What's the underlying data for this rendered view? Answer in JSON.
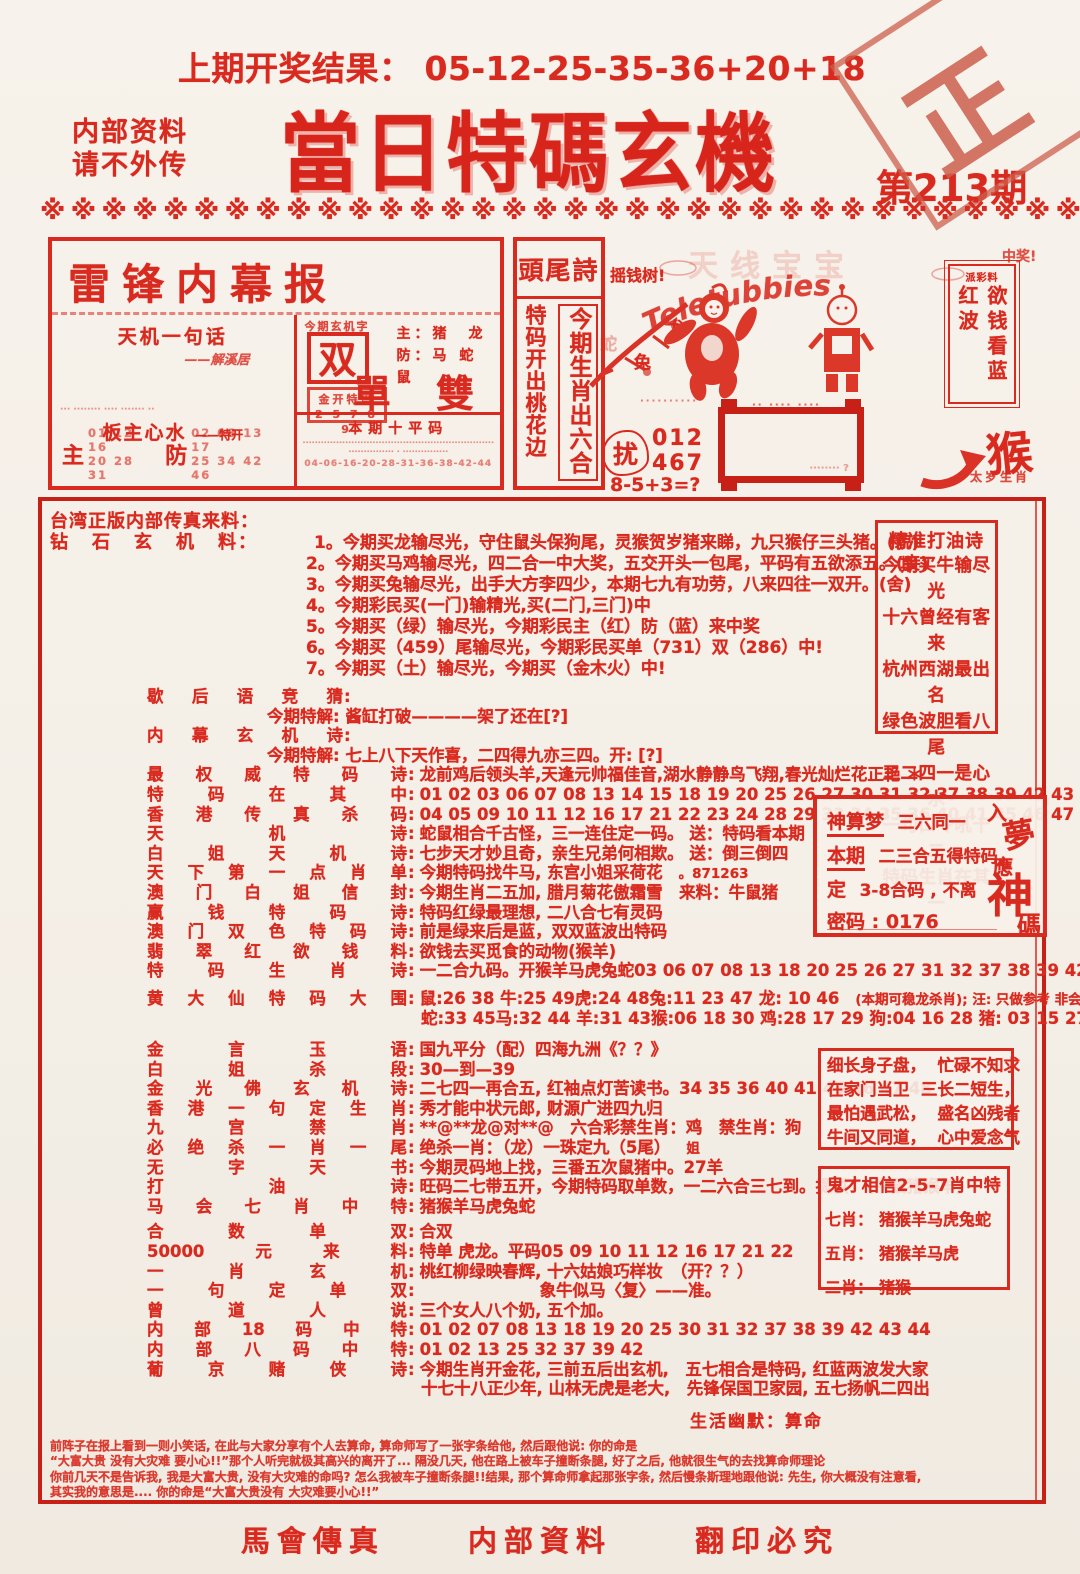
{
  "header": {
    "prev_result": "上期开奖结果： 05-12-25-35-36+20+18",
    "confidential_1": "内部资料",
    "confidential_2": "请不外传",
    "title": "當日特碼玄機",
    "issue": "第213期",
    "stamp_char_1": "正",
    "stamp_char_2": "版",
    "divider": "※※※※※※※※※※※※※※※※※※※※※※※※※※※※※※※※※※※※"
  },
  "leifeng": {
    "title": "雷锋内幕报",
    "tianji_title": "天机一句话",
    "tianji_sig": "——解溪居",
    "smudge": "··· ········ ···· ······· ··",
    "banzhu": "板主心水",
    "banzhu_sub": "——特开",
    "zhu_label": "主",
    "zhu_nums_1": "01 12 16",
    "zhu_nums_2": "20 28 31",
    "fang_label": "防",
    "fang_nums_1": "02 08 13 17",
    "fang_nums_2": "25 34 42 46",
    "xuanji_head": "今期玄机字",
    "xuanji_char": "双",
    "zhu_line": "主：猪　龙",
    "fang_line": "防：马 蛇 鼠",
    "jk_line1": "金开特玛",
    "jk_line2": "2 5 7 8 9",
    "dan_shuang": "單 雙",
    "ten_title": "本期十平码",
    "ten_smudge1": "·······························································",
    "ten_smudge2": "··············· · ···············",
    "ten_nums": "04-06-16-20-28-31-36-38-42-44"
  },
  "touwei": {
    "title": "頭尾詩",
    "left_verse": "特码开出桃花边",
    "right_verse": "今期生肖出六合"
  },
  "tele": {
    "faint_cn": "天线宝宝",
    "arc": "Teletubbies",
    "money_tree": "摇钱树!",
    "win": "中奖!",
    "branch_char_1": "龙",
    "branch_char_2": "兔",
    "branch_char_3": "蛇",
    "rao": "扰",
    "nums_1": "012",
    "nums_2": "467",
    "formula": "8-5+3=?",
    "banner_smudge_1": "··········",
    "banner_smudge_2": "·· ···· ····",
    "box_smudge": "········ ?",
    "monkey": "猴",
    "monkey_caption": "太岁生肖"
  },
  "paicai": {
    "head": "派彩料",
    "body": "欲钱看蓝红波"
  },
  "sec1": {
    "intro": "台湾正版内部传真来料：",
    "label": "钻石玄机料",
    "colon": "：",
    "first": "1。今期买龙输尽光，守住鼠头保狗尾，灵猴贺岁猪来睇，九只猴仔三头猪。(貌)",
    "items": [
      "2。今期买马鸡输尽光，四二合一中大奖，五交开头一包尾，平码有五欲添五。(妾)",
      "3。今期买兔输尽光，出手大方李四少，本期七九有功劳，八来四往一双开。(舍)",
      "4。今期彩民买(一门)输精光,买(二门,三门)中",
      "5。今期买（绿）输尽光，今期彩民主（红）防（蓝）来中奖",
      "6。今期买（459）尾输尽光，今期彩民买单（731）双（286）中!",
      "7。今期买（土）输尽光，今期买（金木火）中!"
    ]
  },
  "main": {
    "rows": [
      {
        "c": "s g8",
        "l": "歇后语竞猜",
        "lc": ":"
      },
      {
        "c": "c",
        "t": "今期特解: 酱缸打破————架了还在[?]"
      },
      {
        "c": "s",
        "l": "内幕玄机诗",
        "lc": ":"
      },
      {
        "c": "c",
        "t": "今期特解: 七上八下天作喜，二四得九亦三四。开: [?]"
      },
      {
        "c": "r",
        "l": "最权威特码诗",
        "lc": ":",
        "t": "龙前鸡后领头羊,天逢元帅福佳音,湖水静静鸟飞翔,春光灿烂花正艳 ＊"
      },
      {
        "c": "r",
        "l": "特码在其中",
        "lc": ":",
        "t": "01 02 03 06 07 08 13 14 15 18 19 20 25 26 27 30 31 32 37 38 39 42 43 44 49"
      },
      {
        "c": "r",
        "l": "香港传真杀码",
        "lc": ":",
        "t": "04 05 09 10 11 12 16 17 21 22 23 24 28 29 33 34 35 36 40 41 45 46 47 48"
      },
      {
        "c": "r",
        "l": "天机诗",
        "lc": ":",
        "t": "蛇鼠相合千古怪，三一连住定一码。 送：特码看本期"
      },
      {
        "c": "r",
        "l": "白姐天机诗",
        "lc": ":",
        "t": "七步天才妙且奇，亲生兄弟何相欺。 送：倒三倒四"
      },
      {
        "c": "r",
        "l": "天下第一点肖单",
        "lc": ":",
        "t": "今期特码找牛马, 东宫小姐采荷花",
        "x": "。871263"
      },
      {
        "c": "r",
        "l": "澳门白姐信封",
        "lc": ":",
        "t": "今期生肖二五加, 腊月菊花傲霜雪　来料：牛鼠猪"
      },
      {
        "c": "r",
        "l": "赢钱特码诗",
        "lc": ":",
        "t": "特码红绿最理想, 二八合七有灵码"
      },
      {
        "c": "r",
        "l": "澳门双色特码诗",
        "lc": ":",
        "t": "前是绿来后是蓝，双双蓝波出特码"
      },
      {
        "c": "r",
        "l": "翡翠红欲钱料",
        "lc": ":",
        "t": "欲钱去买觅食的动物(猴羊)"
      },
      {
        "c": "r",
        "l": "特码生肖诗",
        "lc": ":",
        "t": "一二合九码。开猴羊马虎兔蛇03 06 07 08 13 18  20 25 26 27 31 32 37 38 39 42 43"
      },
      {
        "c": "r g8",
        "l": "黄大仙特码大围",
        "lc": ":",
        "t": "鼠:26 38  牛:25 49虎:24 48兔:11 23 47 龙: 10 46",
        "x": "(本期可稳龙杀肖); 汪: 只做参考 非会员料！！"
      },
      {
        "c": "n2",
        "t": "蛇:33 45马:32 44  羊:31 43猴:06 18 30 鸡:28 17 29 狗:04 16 28  猪: 03 15 27 39"
      },
      {
        "c": "r g12",
        "l": "金言玉语",
        "lc": ":",
        "t": "国九平分（配）四海九洲《？？》"
      },
      {
        "c": "r",
        "l": "白姐杀段",
        "lc": ":",
        "t": "30—到—39"
      },
      {
        "c": "r",
        "l": "金光佛玄机诗",
        "lc": ":",
        "t": "二七四一再合五, 红袖点灯苦读书。34 35 36 40 41 45 46 47 48"
      },
      {
        "c": "r",
        "l": "香港一句定生肖",
        "lc": ":",
        "t": "秀才能中状元郎, 财源广进四九归"
      },
      {
        "c": "r",
        "l": "九宫禁肖",
        "lc": ":",
        "t": "**@**龙@对**@　六合彩禁生肖：鸡　禁生肖：狗"
      },
      {
        "c": "r",
        "l": "必绝杀一肖一尾",
        "lc": ":",
        "t": "绝杀一肖：（龙）一珠定九（5尾）",
        "x": "姐"
      },
      {
        "c": "r",
        "l": "无字天书",
        "lc": ":",
        "t": "今期灵码地上找，三番五次鼠猪中。27羊"
      },
      {
        "c": "r",
        "l": "打油诗",
        "lc": ":",
        "t": "旺码二七带五开，今期特码取单数，一二六合三七到。提供：（牛鼠猪猴羊）"
      },
      {
        "c": "r",
        "l": "马会七肖中特",
        "lc": ":",
        "t": "猪猴羊马虎兔蛇"
      },
      {
        "c": "r g6",
        "l": "合数单双",
        "lc": ":",
        "t": "合双"
      },
      {
        "c": "r",
        "l": "50000元来料",
        "lc": ":",
        "t": "特单 虎龙。平码05 09 10 11 12 16 17 21 22"
      },
      {
        "c": "r",
        "l": "一肖玄机",
        "lc": ":",
        "t": "桃红柳绿映春辉, 十六姑娘巧样妆　（开？？）"
      },
      {
        "c": "r far",
        "l": "一句定单双",
        "lc": ":",
        "t": "象牛似马〈复〉——准。"
      },
      {
        "c": "r",
        "l": "曾道人说",
        "lc": ":",
        "t": "三个女人八个奶, 五个加。"
      },
      {
        "c": "r",
        "l": "内部18码中特",
        "lc": ":",
        "t": "01 02 07 08 13 18 19 20 25 30 31 32 37 38 39 42 43 44"
      },
      {
        "c": "r",
        "l": "内部八码中特",
        "lc": ":",
        "t": "01 02 13 25 32 37 39 42"
      },
      {
        "c": "r",
        "l": "葡京赌侠诗",
        "lc": ":",
        "t": "今期生肖开金花, 三前五后出玄机,　五七相合是特码, 红蓝两波发大家"
      },
      {
        "c": "n2",
        "t": "十七十八正少年, 山林无虎是老大,　先锋保国卫家园, 五七扬帆二四出"
      }
    ]
  },
  "jingzhun": {
    "title": "精准打油诗",
    "lines": [
      "今期买牛输尽光",
      "十六曾经有客来",
      "杭州西湖最出名",
      "绿色波胆看八尾",
      "三二四一是心水",
      "一句口令吼十二",
      "特码生肖在其一"
    ]
  },
  "shensuan": {
    "t1": "神算梦",
    "t1b": "三六同一",
    "t2": "本期",
    "t2b": "二三合五得特码,",
    "t3a": "定",
    "t3b": "3-8合码 , 不离",
    "pwd": "密码 : 0176",
    "v1": "入",
    "v2": "夢",
    "v3": "應",
    "v4": "神",
    "v5": "碼"
  },
  "xichang": {
    "lines": [
      "细长身子盘，  忙碌不知求",
      "在家门当卫  三长二短生，",
      "最怕遇武松，  盛名凶残者",
      "牛间又同道，  心中爱念气"
    ]
  },
  "guicai": {
    "title": "鬼才相信2-5-7肖中特",
    "rows": [
      {
        "k": "七肖：",
        "v": "猪猴羊马虎兔蛇"
      },
      {
        "k": "五肖：",
        "v": "猪猴羊马虎"
      },
      {
        "k": "二肖：",
        "v": "猪猴"
      }
    ]
  },
  "humor": {
    "heading": "生活幽默：算命",
    "lines": [
      "前阵子在报上看到一则小笑话, 在此与大家分享有个人去算命, 算命师写了一张字条给他, 然后跟他说: 你的命是",
      "“大富大贵 没有大灾难 要小心!!”那个人听完就极其高兴的离开了... 隔没几天, 他在路上被车子撞断条腿, 好了之后, 他就很生气的去找算命师理论",
      "你前几天不是告诉我, 我是大富大贵, 没有大灾难的命吗? 怎么我被车子撞断条腿!!结果, 那个算命师拿起那张字条, 然后慢条斯理地跟他说: 先生, 你大概没有注意看,",
      "其实我的意思是.... 你的命是“大富大贵没有 大灾难要小心!!”"
    ]
  },
  "footer": {
    "items": [
      "馬會傳真",
      "内部資料",
      "翻印必究"
    ]
  }
}
